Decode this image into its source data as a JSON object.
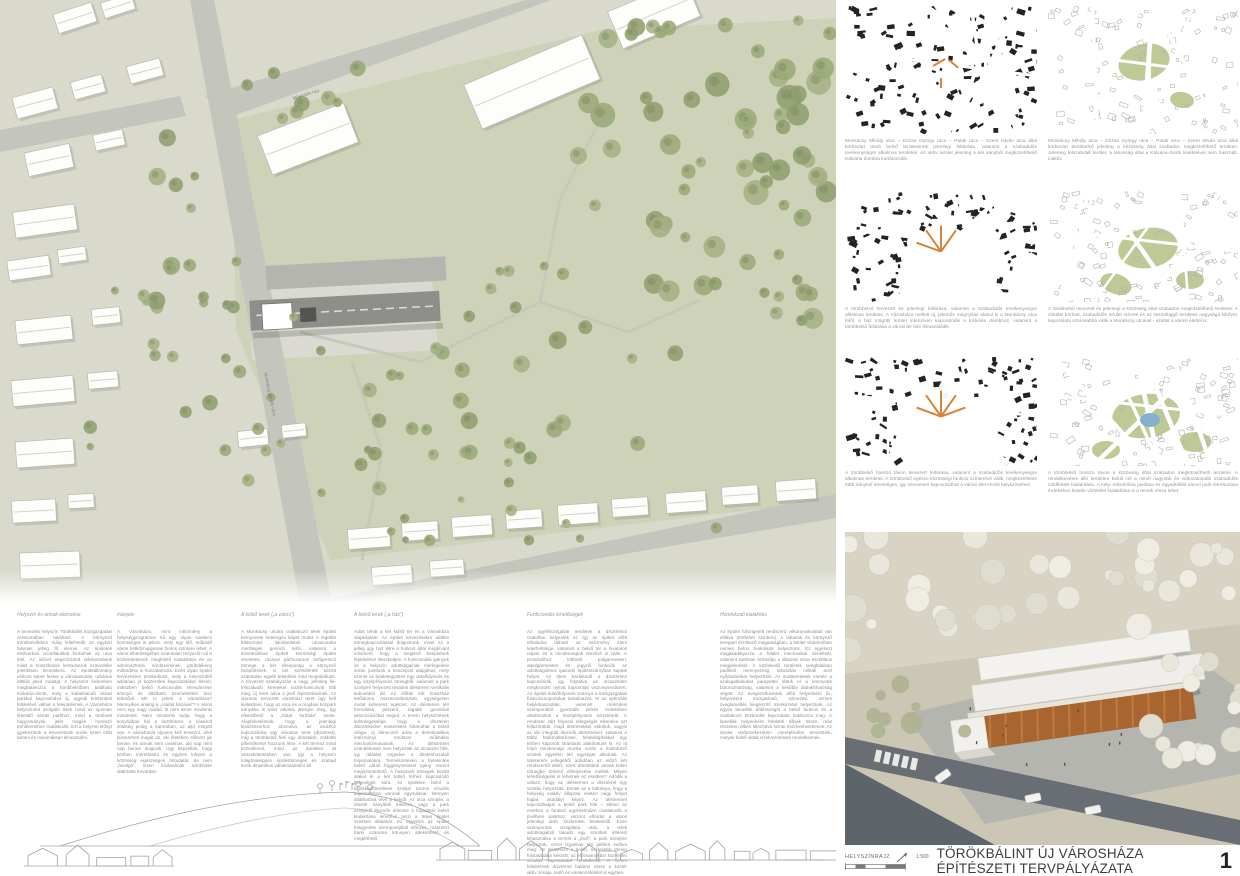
{
  "colors": {
    "accent_green": "#b7c68c",
    "accent_orange": "#d8823a",
    "water_blue": "#86aecd",
    "plan_ground": "#d9dacb",
    "park_green": "#cdd2b8",
    "road_gray": "#c4c6bd",
    "roof_dark": "#8e8e8a",
    "render_roof": "#a9652f",
    "road_dark": "#686e73",
    "title_color": "#3c3c3c"
  },
  "footer": {
    "legend_label": "HELYSZÍNRAJZ",
    "scale": "1:500",
    "title": "TÖRÖKBÁLINT ÚJ VÁROSHÁZA ÉPÍTÉSZETI TERVPÁLYÁZATA",
    "sheet_number": "1"
  },
  "plan_labels": {
    "street": "Munkácsy Mihály utca",
    "monument": "Műemléki ház"
  },
  "diagrams": [
    {
      "caption": "Munkácsy Mihály utca – Dózsa György utca – Patak utca – Szent István utca által körbezárt tömb belső területeinek jelenlegi feltárása, valamint a szabadidős tevékenységre alkalmas területek. Az aktív terület jelenleg a két irányból megközelíthető Kálvária dombra korlátozódik."
    },
    {
      "caption": "Munkácsy Mihály utca – Dózsa György utca – Patak utca – Szent István utca által körbezárt tömbbelső jelenleg a közösség által szabadon megközelíthető területei. Jelenleg felszabdalt terület, a lakosság által a Kálvária-domb kivételével nem használt, inaktív."
    },
    {
      "caption": "A tömbbelső tervezett és jelenlegi feltárása, valamint a szabadidős tevékenységre alkalmas területei. A Városháza mellett új, jelentős megnyitás alakul ki a Munkácsy utca felől, a ház mögötti terület intenzíven kapcsolódik a Kálvária dombhoz, valamint a tömbbelső feltárása a városi tér felé fókuszálódik."
    },
    {
      "caption": "A tömbbelső tervezett és jelenlegi a közösség által szabadon megközelíthető területei. A zölddel borított, szabadidős terület mérete és az összefüggő területek nagysága kibővül, kapcsolata szorosabbá válik a Munkácsy utcával - ezáltal a városi élettel is."
    },
    {
      "caption": "A tömbbelső hosszú távon tervezett feltárása, valamint a szabadidős tevékenységre alkalmas területei. A tömbbelső egésze közösségi funkció színterévé válik, megközelítése több irányból lehetséges, így szervesen kapcsolódhat a városi élet közeli helyszíneihez."
    },
    {
      "caption": "A tömbbelső hosszú távon a közösség által szabadon megközelíthető területei. A rendelkezésre álló területen belüli cél a minél nagyobb és változatosabb szabadidős zöldfelület kialakítása. A helyi mikroklíma javítása és egyedülálló városi park létrehozása érdekében kisebb vízfelület kialakítása is a tervek része lehet."
    }
  ],
  "essay_columns": [
    {
      "heading": "Helyszín és annak elemzése",
      "body": "A tervezési helyszín Törökbálint közigazgatási centrumában található. A környező tömbbelsőkben máig fellelhetők az egykori falusias jelleg fő elemei. Az épületek elsősorban oromfalukkal fordulnak az utca felé. Az idővel elaprózódott telekosztások miatt a hosszházas kertudvarok szövedéke jelentősen lecsökkent. Az épületállomány változó képet festve a városiasodás, urbánus attitűd jeleit mutatja. A helyszínt érdemben meghatározza a tömbbelsőben található Kálvária-domb, mely a kialakítandó városi parkkal kapcsolódva új, egyedi közterületi felületévé válhat a településnek. A Városháza helyszínéül szolgáló telek mind az újonnan létesülő városi parkhoz, mind a történeti hagyományok jelét magán hordozó tömbkerethez csatlakozik. Ezt a helyzeti előnyt igyekeztünk a tervezésünk során szem előtt tartani és maximálisan kihasználni."
    },
    {
      "heading": "Irányelv",
      "body": "A Városháza, mint intézmény a helyiségprogramon túl egy olyan szellemi közösséget is jelent, mely egy élő, működő város hétköznapjainak fontos színtere lehet. A város élhetőségéhez számtalan tényezőn túl a közterületeinek megfelelő kialakítása és az adminisztratív rendszereinek gördülékeny működése is hozzátartozik. Ezért olyan épület tervezésére törekedtünk, mely a helyszínből adódóan jó közterületi kapcsolatokat létesít, miközben belső funkcionális elrendezése könnyű és átlátható üzemeltetést tesz lehetővé. Mit is jelent a Városháza? Mennyiben analóg a „család házával”? A város nem egy nagy család. Itt nem ismer mindenki mindenkit. Nem mindenki tudja, hogy a konyhában hol a tisztítószer, a vásárolt zöldség pedig a kamrában, az ajtó mögött van. A városházát olyanra kell tervezni, ahol kiismerheti magát az, aki életében először jár benne, és annak sem unalmas, aki nap mint nap benne dolgozik. Úgy képzeltük, hogy közben mértéktartó és egyben kifejezi a közösség egészséges öntudatát, de nem „hivalgó”. Ezen kívánalmak szintézise alakította tervünket."
    },
    {
      "heading": "A külső terek („a város”)",
      "body": "A Munkácsy utcára csatlakozó telek épített környezete heterogén képet mutat. A régebbi földszintes lakóépületek utcavonalra merőleges gerincű tetői, valamint a közelmúltban épített közösségi épület emeletes, utcával párhuzamos tetőgerincű tömege a két ellenpontja a környező beépítésnek. E két szélsőérték között számtalan egyéb telepítési mód megtalálható. A tervezett szabályozás a nagy, jelenleg fel-felszakadó kereteket köztérfunkcióval tölti meg, új teret adva a jövő fejlesztéseinek. Az újonnan tervezett városházi teret úgy kell kialakítani, hogy az utca és a majdani közpark irányába is teret alkotva jelenjen meg, így elkerülhető a „hátat fordítás” esete. Alapfelvetésünk, hogy a jelenlegi kisüzletsorhoz idomulva, az utcához kapcsolódva egy városias teret (díszteret), míg a tömbbelső felé egy oldottabb, zöldebb pihenőkertet hozzunk létre. A két térrész mind közvetlenül, mind az épületen át összeköttetésben van, így a helyszín tulajdonképpen épülettömegek és szabad terek dinamikus váltakozásából áll."
    },
    {
      "heading": "A belső terek („a ház”)",
      "body": "Adott tehát a két külső tér és a Városháza alapképlete. Az épület tervezésekor additív tömegkapcsolással dolgoztunk, mivel ez a jelleg úgy hoz létre a funkció által megkívánt volument, hogy a meglévő beépítések léptékéhez illeszkedjen. A funkcionális igények és a helyszín adottságainak mérlegelése során jutottunk a koncepció alapjához, mely szerint az épületegyüttes egy oldalfolyosós és egy középfolyosós tömegből, valamint a park szintjére helyezett testületi ülésterem vertikális kubusából áll. Az előbbi két hosszház tetőidoma összeszerkesztett, egységesen mutat koherens egészet. Az ülésterem téri formálása jelszerű, tágabb gondolati asszociációkat enged. A terem helyszínének különlegessége, hogy a díszteren átközlekedve esetenként feltárulhat a belső világa, új dimenziót adva a demokratikus intézményi rendszer működési mechanizmusainak. Az üléstermet szándékosan nem helyeztük az utcaszint fölé, így rálátást engedve a döntéshozatali folyamatokra. Természetesen a betekintés belső oldali függönyözéssel igény szerint megszüntethető. A hosszanti tömegek között alakul ki a két külső térhez kapcsolódó helyiségek sora. Az épületen belül a közlekedőterületek szintjei szoros vizuális kapcsolatban vannak egymással, könnyen átláthatóvá téve a belsőt. Az utca szintjén, a dísztér irányából érkezve, vagy a park szintjéről lépcsőn érkezve a fogadótér belső kialakítása lehetővé teszi a teljes épület szintbeli átlátását. Ez egyrészt az épület felügyelete szempontjából előnyös, másrészt bárki számára könnyen áttekinthető és megérthető."
    },
    {
      "heading": "Funkcionális lehetőségek",
      "body": "Az ügyfélszolgálati területek a dísztérhez csatoltan helyezték el, így az épület előtt elhaladva látható az intézmény itteni leterheltsége, valamint a belső tér a hivatalos napok és a mindennapok részévé is válik. A protokollhoz köthető polgármesteri, alpolgármesteri és jegyzői funkciók az adottságokhoz igazodó épületszárnyban kaptak helyet. Az itteni közlekedő a dísztérhez kapcsolódik, így folytatva az utcaszinten megkezdett nyitott kapcsolati viszonyrendszert. Az épület külsőfolyosós szárnya a közigazgatási funkciócsoportokat tartalmazza. Itt az optimális helykihasználás, valamint működési szempontból gyorsabb elérés érdekében alkalmaztuk a középfolyosós szisztémát. A rendszer zárt folyosói ridegségét elkerülve azt fellazítottuk, majd áttörésekkel oldottuk, vagyis az ide integrált lépcsők áttöréseivel, valamint a többi födémáttöréssel, felülvilágítókkal egy térben kapcsolt struktúrát alakítottunk ki. Az itt folyó mindennapi munka során a különböző szintek egyetlen téri egységet alkotnak. Az ülésterem jellegéből adódóan az előző két rendszertől eltért, ezért döntöttünk annak külön tömegbe történő elhelyezése mellett. Milyen lehetőségeink is lehetnek ez esetben? Adódik a válasz, hogy az üléstermet a dísztérrel egy szintbe helyezzük. Ennek az a hátránya, hogy a helyiség inaktív állapota esetén nagy helyet foglal, akadályt képez. Az üléstermet kapcsolhatjuk a belső park felé – ebben az esetben a funkció egyértelműen csatlakozik a jövőbeni parkhoz, viszont elfordul a város jelenlegi aktív közterületi felületeitől. Ezen szempontok vizsgálata után, a telek adottságaiból fakadó egy szintbeli eltérést kihasználva a termet a „jövő”, a park szintjére helyeztük, ezzel izgalmas téri játékot indítva meg. Az ülésterem a belső, szélesebb tömeg folytatásába készült, az előcsarnokból közvetlen vizuális kapcsolattal rendelkezik. A terem felületének dísztérrel határos része a köztér aktív zónája, leülő és várakozófelület is egyben."
    },
    {
      "heading": "Homlokzati kialakítás",
      "body": "Az épület hőszigetelt rendszerű vékonyvakolattal van ellátva (törtfehér színben). A lábazati és környező tereppel érintkező magasságban, a felület védelmében nemes beton burkolatot helyeztünk. Ez egyrészt megakadályozza a felület mechanikai sérülését, valamint tartósan biztosítja a lábazati zóna esztétikus megjelenését. A közlekedő területek üvegfalaiban padlótól mennyezetig tokosztás nélküli acél nyílászárókat helyeztünk. Az irodaterületek esetén a szalagablakokat parapettel láttuk el a könnyebb bútorozhatóság, valamint a későbbi átalakíthatóság végett. Az üvegszerkezetek előtt helyenként fix, helyenként mozgatható, színezett, színes üveglamellás kiegészítő szerkezetet helyeztünk. Az egyes lamellák dőlésszögét a belső funkció és a csatlakozó közterület kapcsolata határozza meg. A lamellák helyenként felületté állnak össze, más részeken élben látszódva szinte észrevehetetlenek. Az épület tetőszerkezetein cserépfedést terveztünk, melyek külső oldali vízelvezetéssel rendelkeznek."
    }
  ]
}
